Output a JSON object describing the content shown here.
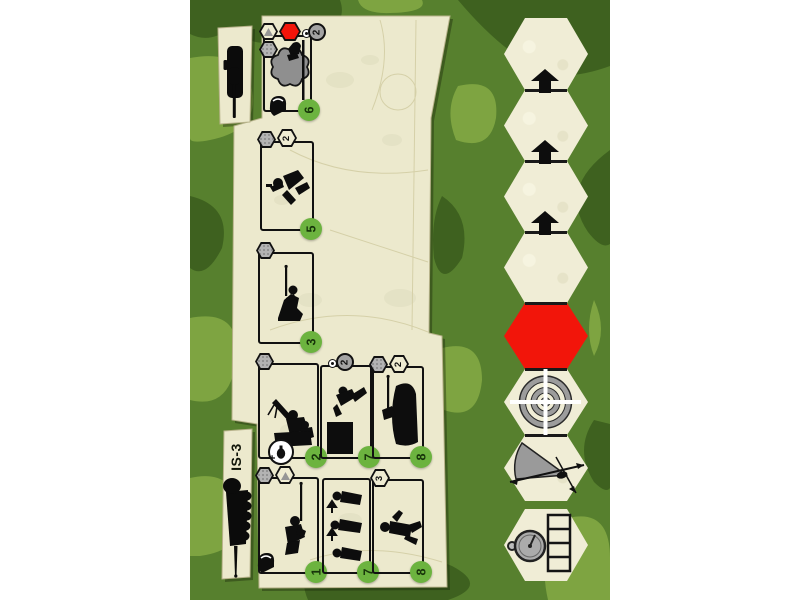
{
  "unit": {
    "name": "IS-3"
  },
  "panel": {
    "cards": [
      {
        "id": "smoke",
        "cost": "6",
        "ammo": "2",
        "art": "smoke-screen",
        "top_icons": [
          "terrain-hex",
          "red-hex",
          "rally-dot",
          "ammo-circle"
        ],
        "side_icons": [
          "action-hex"
        ],
        "bottom_icons": [
          "helmet"
        ]
      },
      {
        "id": "crawl",
        "cost": "5",
        "hex_value": "2",
        "art": "crawling-soldier",
        "top_icons": [
          "action-hex",
          "value-hex"
        ]
      },
      {
        "id": "kneel",
        "cost": "3",
        "art": "kneeling-rifleman",
        "top_icons": [
          "action-hex"
        ]
      },
      {
        "id": "mg-team",
        "cost": "2",
        "plus": "+",
        "art": "machine-gun-team",
        "top_icons": [
          "action-hex"
        ],
        "bottom_icons": [
          "grenade-circle"
        ]
      },
      {
        "id": "assault",
        "cost": "7",
        "ammo": "2",
        "art": "vaulting-soldier",
        "top_icons": [
          "rally-dot",
          "ammo-circle"
        ]
      },
      {
        "id": "overwatch",
        "cost": "8",
        "hex_value": "2",
        "art": "rifleman-in-cover",
        "top_icons": [
          "action-hex",
          "value-hex"
        ]
      },
      {
        "id": "sniper",
        "cost": "1",
        "art": "sniper",
        "top_icons": [
          "action-hex",
          "terrain-hex"
        ],
        "bottom_icons": [
          "helmet"
        ]
      },
      {
        "id": "advance",
        "cost": "7",
        "art": "advancing-squad",
        "top_icons": []
      },
      {
        "id": "rifleman",
        "cost": "8",
        "hex_value": "3",
        "art": "standing-rifleman",
        "top_icons": [
          "value-hex"
        ]
      }
    ]
  },
  "track": {
    "cells": [
      {
        "type": "plain"
      },
      {
        "type": "arrow-up"
      },
      {
        "type": "arrow-up"
      },
      {
        "type": "arrow-up"
      },
      {
        "type": "red-marker"
      },
      {
        "type": "target"
      },
      {
        "type": "fire-arc"
      }
    ],
    "timer": {
      "type": "stopwatch",
      "segments": 4
    }
  },
  "colors": {
    "camo_base": "#57802e",
    "camo_light": "#7ea441",
    "camo_dark": "#3e611f",
    "parchment": "#ece9cd",
    "hex_cream": "#f0edd6",
    "red": "#f2150a",
    "cost_green": "#6cb33f"
  }
}
